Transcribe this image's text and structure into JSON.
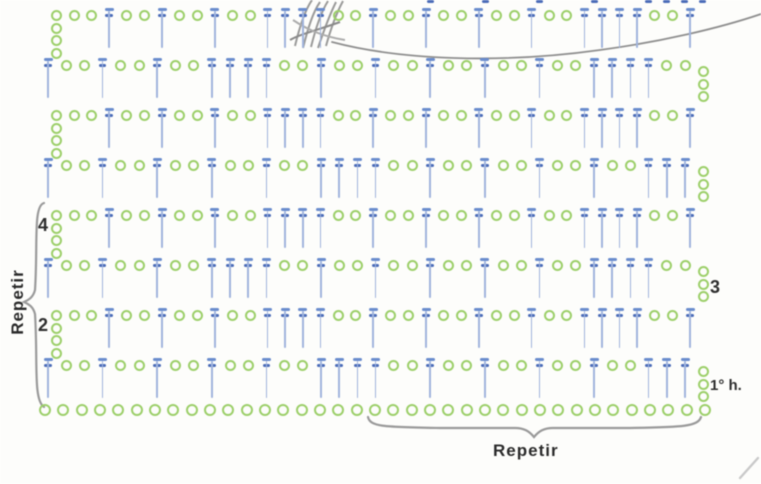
{
  "diagram": {
    "kind": "crochet stitch chart",
    "stitch_key": {
      "o": "chain stitch",
      "T": "double crochet"
    },
    "colors": {
      "chain_green": "#9ccf69",
      "dc_bar_blue": "#6a8ccd",
      "dc_tick_blue": "#4b6cb8",
      "dc_stem_blue": "#a0b4dd",
      "annotation_gray": "#9a9a9a",
      "label_dark": "#2e2e2e"
    },
    "labels": {
      "repeat_vertical": "Repetir",
      "repeat_horizontal": "Repetir",
      "first_row": "1° h.",
      "row2": "2",
      "row3": "3",
      "row4": "4"
    },
    "foundation_chain": {
      "count": 37
    },
    "rows": [
      {
        "n": 1,
        "tch_side": "right",
        "tch_count": 3,
        "label": "1° h.",
        "tokens": "TooTooTooTooTooTTTTooTooTooTooTooTTT"
      },
      {
        "n": 2,
        "tch_side": "left",
        "tch_count": 4,
        "label": "2",
        "tokens": "ooTooTooTooTTTTooTooTooTooTooTTTTooT"
      },
      {
        "n": 3,
        "tch_side": "right",
        "tch_count": 3,
        "label": "3",
        "tokens": "TooTooTooTTTTooTooTooTooTooTooTTTToo"
      },
      {
        "n": 4,
        "tch_side": "left",
        "tch_count": 4,
        "label": "4",
        "tokens": "ooTooTooTooTTTTooTooTooTooTooTTTTooT"
      },
      {
        "n": 5,
        "tch_side": "right",
        "tch_count": 3,
        "label": "",
        "tokens": "TooTooTooTooTooTTTTooTooTooTooTooTTT"
      },
      {
        "n": 6,
        "tch_side": "left",
        "tch_count": 4,
        "label": "",
        "tokens": "ooTooTooTooTTTTooTooTooTooTooTTTTooT"
      },
      {
        "n": 7,
        "tch_side": "right",
        "tch_count": 3,
        "label": "",
        "tokens": "TooTooTooTTTTooTooTooTooTooTooTTTToo"
      },
      {
        "n": 8,
        "tch_side": "left",
        "tch_count": 4,
        "label": "",
        "tokens": "ooTooTooTooTTTTooTooTooTooTooTTTTooT"
      }
    ],
    "notes": {
      "top_row_cropped": "row 8 is partially cut by the top edge",
      "annotations": [
        "pencil scribble top-center",
        "hand-drawn curve sweeping to top-right",
        "left brace spans the 4-row repeat",
        "bottom brace spans the horizontal repeat"
      ]
    }
  }
}
